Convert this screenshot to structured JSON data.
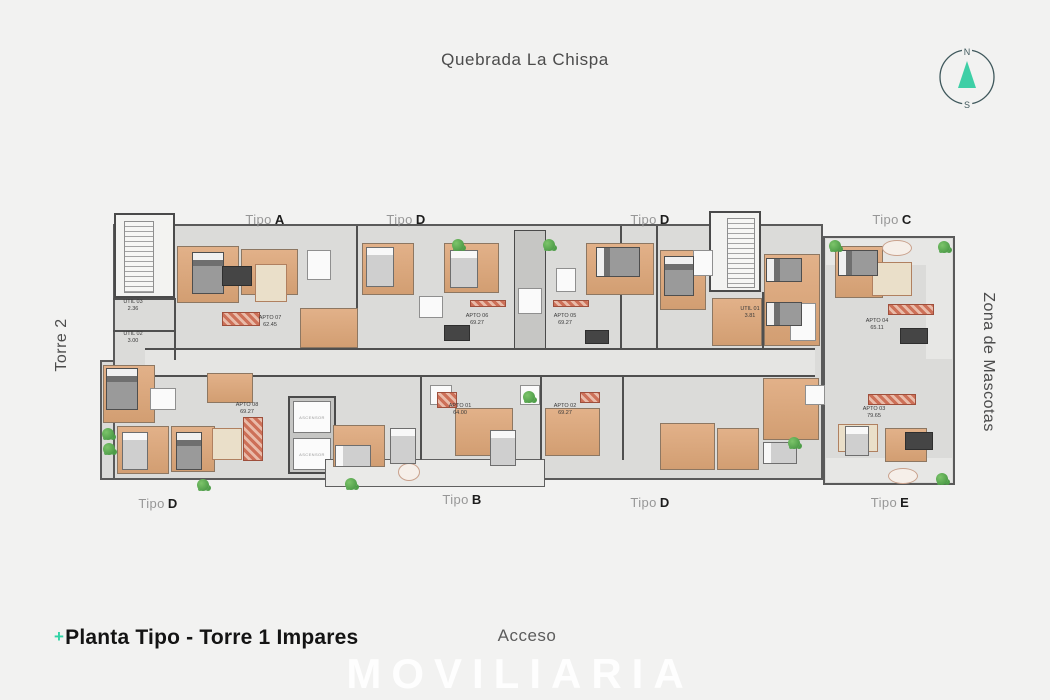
{
  "page": {
    "top_label": "Quebrada La Chispa",
    "left_label": "Torre 2",
    "right_label": "Zona de Mascotas",
    "bottom_center_label": "Acceso",
    "watermark": "MOVILIARIA",
    "title": {
      "plus": "+",
      "text": "Planta Tipo - Torre 1 Impares"
    }
  },
  "compass": {
    "north": "N",
    "south": "S",
    "needle_color": "#3ecfa6",
    "ring_color": "#3f585c"
  },
  "plan": {
    "elevator_label": "ASCENSOR",
    "tipo_labels": [
      {
        "prefix": "Tipo",
        "letter": "A",
        "position": "top"
      },
      {
        "prefix": "Tipo",
        "letter": "D",
        "position": "top"
      },
      {
        "prefix": "Tipo",
        "letter": "D",
        "position": "top"
      },
      {
        "prefix": "Tipo",
        "letter": "C",
        "position": "top"
      },
      {
        "prefix": "Tipo",
        "letter": "D",
        "position": "bottom"
      },
      {
        "prefix": "Tipo",
        "letter": "B",
        "position": "bottom"
      },
      {
        "prefix": "Tipo",
        "letter": "D",
        "position": "bottom"
      },
      {
        "prefix": "Tipo",
        "letter": "E",
        "position": "bottom"
      }
    ],
    "units": [
      {
        "name": "UTIL 03",
        "area": "2.36"
      },
      {
        "name": "UTIL 02",
        "area": "3.00"
      },
      {
        "name": "APTO 07",
        "area": "62.45"
      },
      {
        "name": "APTO 06",
        "area": "69.27"
      },
      {
        "name": "APTO 05",
        "area": "69.27"
      },
      {
        "name": "UTIL 01",
        "area": "3.81"
      },
      {
        "name": "APTO 04",
        "area": "65.11"
      },
      {
        "name": "APTO 08",
        "area": "69.27"
      },
      {
        "name": "APTO 01",
        "area": "64.00"
      },
      {
        "name": "APTO 02",
        "area": "69.27"
      },
      {
        "name": "APTO 03",
        "area": "79.65"
      }
    ],
    "colors": {
      "accent_teal": "#2fd3a5",
      "wall": "#4f4f4f",
      "wood": "#d9a678",
      "floor": "#dbdbd9",
      "rug_red": "#cd7058",
      "plant_green": "#5aab54"
    }
  }
}
